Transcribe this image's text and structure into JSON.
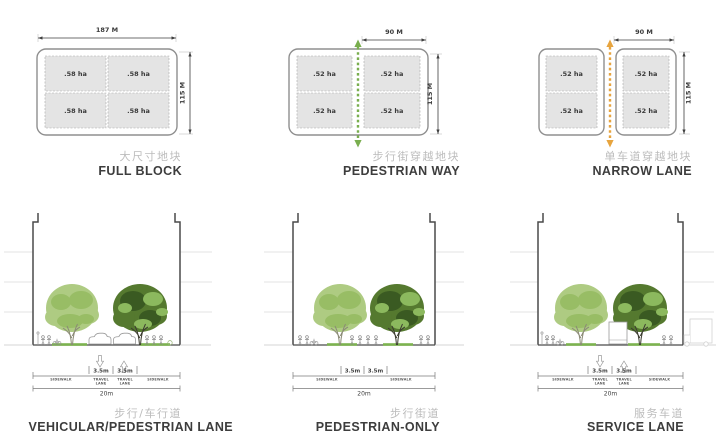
{
  "diagram": {
    "plans": [
      {
        "name": "full-block",
        "caption_cn": "大尺寸地块",
        "caption_en": "FULL BLOCK",
        "width_label": "187 M",
        "height_label": "115 M",
        "quadrants": [
          ".58 ha",
          ".58 ha",
          ".58 ha",
          ".58 ha"
        ]
      },
      {
        "name": "pedestrian-way",
        "caption_cn": "步行街穿越地块",
        "caption_en": "PEDESTRIAN WAY",
        "width_label": "90 M",
        "height_label": "115 M",
        "quadrants": [
          ".52 ha",
          ".52 ha",
          ".52 ha",
          ".52 ha"
        ]
      },
      {
        "name": "narrow-lane",
        "caption_cn": "单车道穿越地块",
        "caption_en": "NARROW LANE",
        "width_label": "90 M",
        "height_label": "115 M",
        "quadrants": [
          ".52 ha",
          ".52 ha",
          ".52 ha",
          ".52 ha"
        ]
      }
    ],
    "sections": [
      {
        "name": "vehicular-pedestrian-lane",
        "caption_cn": "步行/车行道",
        "caption_en": "VEHICULAR/PEDESTRIAN LANE",
        "lane_width_1": "3.5m",
        "lane_width_2": "3.5m",
        "total_width": "20m",
        "zones": {
          "sidewalk": "SIDEWALK",
          "travel_1": "TRAVEL",
          "travel_2": "LANE"
        }
      },
      {
        "name": "pedestrian-only",
        "caption_cn": "步行街道",
        "caption_en": "PEDESTRIAN-ONLY",
        "lane_width_1": "3.5m",
        "lane_width_2": "3.5m",
        "total_width": "20m",
        "zones": {
          "sidewalk": "SIDEWALK"
        }
      },
      {
        "name": "service-lane",
        "caption_cn": "服务车道",
        "caption_en": "SERVICE LANE",
        "lane_width_1": "3.5m",
        "lane_width_2": "3.5m",
        "total_width": "20m",
        "zones": {
          "sidewalk": "SIDEWALK",
          "travel_1": "TRAVEL",
          "travel_2": "LANE"
        }
      }
    ],
    "colors": {
      "pedestrian_arrow": "#79ae4e",
      "service_arrow": "#e7a43e",
      "tree_light": "#aecb82",
      "tree_dark": "#55792f",
      "lawn": "#7cb34f"
    }
  }
}
